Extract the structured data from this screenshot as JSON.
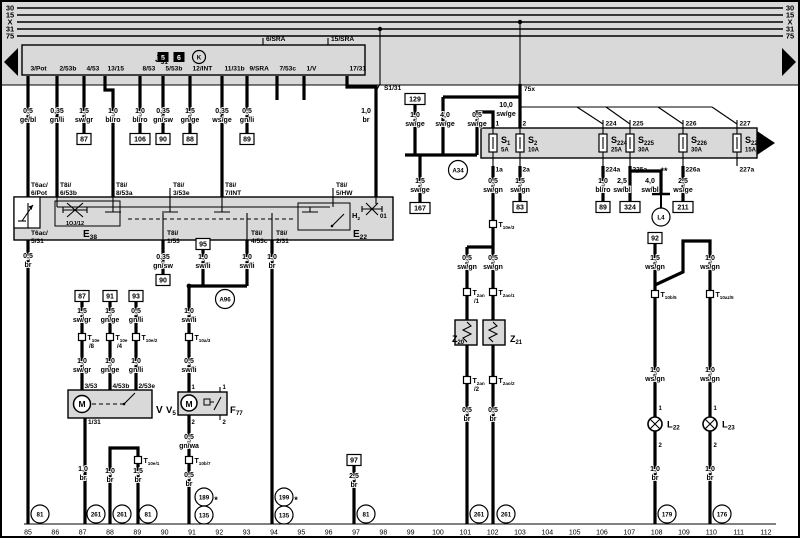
{
  "bus": {
    "left": [
      "30",
      "15",
      "X",
      "31",
      "75"
    ],
    "right": [
      "30",
      "15",
      "X",
      "31",
      "75"
    ]
  },
  "tracks": [
    "85",
    "86",
    "87",
    "88",
    "89",
    "90",
    "91",
    "92",
    "93",
    "94",
    "95",
    "96",
    "97",
    "98",
    "99",
    "100",
    "101",
    "102",
    "103",
    "104",
    "105",
    "106",
    "107",
    "108",
    "109",
    "110",
    "111",
    "112"
  ],
  "relay": {
    "name": "J|31",
    "badges": [
      {
        "x": 163,
        "y": 60,
        "t": "5"
      },
      {
        "x": 179,
        "y": 60,
        "t": "6"
      }
    ],
    "symbol": {
      "x": 199,
      "y": 57,
      "t": "K"
    }
  },
  "wspecs": [
    [
      28,
      113,
      "0,5",
      "ge/bl"
    ],
    [
      57,
      113,
      "0,35",
      "gn/li"
    ],
    [
      84,
      113,
      "1,5",
      "sw/gr"
    ],
    [
      113,
      113,
      "1,0",
      "bl/ro"
    ],
    [
      140,
      113,
      "1,0",
      "bl/ro"
    ],
    [
      163,
      113,
      "0,35",
      "gn/sw"
    ],
    [
      190,
      113,
      "1,5",
      "gn/ge"
    ],
    [
      222,
      113,
      "0,35",
      "ws/ge"
    ],
    [
      247,
      113,
      "0,5",
      "gn/li"
    ],
    [
      366,
      113,
      "1,0",
      "br"
    ],
    [
      415,
      117,
      "1,0",
      "sw/ge"
    ],
    [
      445,
      117,
      "4,0",
      "sw/ge"
    ],
    [
      477,
      117,
      "0,5",
      "sw/ge"
    ],
    [
      506,
      107,
      "10,0",
      "sw/ge"
    ],
    [
      420,
      183,
      "1,5",
      "sw/ge"
    ],
    [
      493,
      183,
      "0,5",
      "sw/gn"
    ],
    [
      520,
      183,
      "1,5",
      "sw/gn"
    ],
    [
      603,
      183,
      "1,0",
      "bl/ro"
    ],
    [
      622,
      183,
      "2,5",
      "sw/bl"
    ],
    [
      650,
      183,
      "4,0",
      "sw/bl"
    ],
    [
      683,
      183,
      "2,5",
      "ws/ge"
    ],
    [
      28,
      258,
      "0,5",
      "br"
    ],
    [
      163,
      259,
      "0,35",
      "gn/sw"
    ],
    [
      203,
      259,
      "1,0",
      "sw/li"
    ],
    [
      247,
      259,
      "1,0",
      "sw/li"
    ],
    [
      272,
      259,
      "1,0",
      "br"
    ],
    [
      189,
      313,
      "1,0",
      "sw/li"
    ],
    [
      82,
      313,
      "1,5",
      "sw/gr"
    ],
    [
      110,
      313,
      "1,5",
      "gn/ge"
    ],
    [
      136,
      313,
      "0,5",
      "gn/li"
    ],
    [
      82,
      363,
      "1,0",
      "sw/gr"
    ],
    [
      110,
      363,
      "1,0",
      "gn/ge"
    ],
    [
      136,
      363,
      "1,0",
      "gn/li"
    ],
    [
      189,
      363,
      "0,5",
      "sw/li"
    ],
    [
      189,
      439,
      "0,5",
      "gn/wa"
    ],
    [
      83,
      471,
      "1,0",
      "br"
    ],
    [
      110,
      473,
      "1,0",
      "br"
    ],
    [
      138,
      473,
      "1,5",
      "br"
    ],
    [
      189,
      477,
      "0,5",
      "br"
    ],
    [
      354,
      478,
      "2,5",
      "br"
    ],
    [
      467,
      260,
      "0,5",
      "sw/gn"
    ],
    [
      493,
      260,
      "0,5",
      "sw/gn"
    ],
    [
      467,
      412,
      "0,5",
      "br"
    ],
    [
      493,
      412,
      "0,5",
      "br"
    ],
    [
      655,
      260,
      "1,5",
      "ws/gn"
    ],
    [
      710,
      260,
      "1,0",
      "ws/gn"
    ],
    [
      655,
      372,
      "1,0",
      "ws/gn"
    ],
    [
      710,
      372,
      "1,0",
      "ws/gn"
    ],
    [
      655,
      471,
      "1,0",
      "br"
    ],
    [
      710,
      471,
      "1,0",
      "br"
    ]
  ],
  "texts": [
    [
      30.5,
      70.5,
      "3/Pot",
      "tl"
    ],
    [
      59.5,
      70.5,
      "2/53b",
      "tl"
    ],
    [
      86.5,
      70.5,
      "4/53",
      "tl"
    ],
    [
      107.5,
      70.5,
      "13/15",
      "tl"
    ],
    [
      142.5,
      70.5,
      "8/53",
      "tl"
    ],
    [
      165.5,
      70.5,
      "5/53b",
      "tl"
    ],
    [
      192.5,
      70.5,
      "12/INT",
      "tl"
    ],
    [
      224.5,
      70.5,
      "11/31b",
      "tl"
    ],
    [
      249.5,
      70.5,
      "9/SRA",
      "tl"
    ],
    [
      279.5,
      70.5,
      "7/53c",
      "tl"
    ],
    [
      306.5,
      70.5,
      "1/V",
      "tl"
    ],
    [
      349.5,
      70.5,
      "17/31",
      "tl"
    ],
    [
      266,
      41,
      "6/SRA",
      "tl"
    ],
    [
      331,
      41,
      "15/SRA",
      "tl"
    ],
    [
      384,
      90,
      "S1/31",
      "tl"
    ],
    [
      524,
      91,
      "75x",
      "tl"
    ],
    [
      31,
      187,
      "T6ac/",
      "tl"
    ],
    [
      31,
      195,
      "6/Pot",
      "tl"
    ],
    [
      60,
      187,
      "T8i/",
      "tl"
    ],
    [
      60,
      195,
      "6/53b",
      "tl"
    ],
    [
      116,
      187,
      "T8i/",
      "tl"
    ],
    [
      116,
      195,
      "8/53a",
      "tl"
    ],
    [
      173,
      187,
      "T8i/",
      "tl"
    ],
    [
      173,
      195,
      "3/53e",
      "tl"
    ],
    [
      225,
      187,
      "T8i/",
      "tl"
    ],
    [
      225,
      195,
      "7/INT",
      "tl"
    ],
    [
      336,
      187,
      "T8i/",
      "tl"
    ],
    [
      336,
      195,
      "5/HW",
      "tl"
    ],
    [
      31,
      235,
      "T6ac/",
      "tl"
    ],
    [
      31,
      243,
      "5/31",
      "tl"
    ],
    [
      167,
      235,
      "T8i/",
      "tl"
    ],
    [
      167,
      243,
      "1/53",
      "tl"
    ],
    [
      251,
      235,
      "T8i/",
      "tl"
    ],
    [
      251,
      243,
      "4/53c",
      "tl"
    ],
    [
      276,
      235,
      "T8i/",
      "tl"
    ],
    [
      276,
      243,
      "2/31",
      "tl"
    ],
    [
      84.5,
      388,
      "3/53",
      "tl"
    ],
    [
      112.5,
      388,
      "4/53b",
      "tl"
    ],
    [
      138.5,
      388,
      "2/53e",
      "tl"
    ],
    [
      88,
      424,
      "1/31",
      "tl"
    ],
    [
      191.5,
      389,
      "1",
      "pin"
    ],
    [
      191.5,
      424,
      "2",
      "pin"
    ],
    [
      222.5,
      389,
      "1",
      "pin"
    ],
    [
      222.5,
      424,
      "2",
      "pin"
    ],
    [
      380,
      218,
      "01",
      "pin"
    ],
    [
      216,
      503,
      "*",
      "star"
    ],
    [
      296,
      503,
      "*",
      "star"
    ],
    [
      637,
      176,
      "*",
      "star"
    ],
    [
      664,
      174,
      "**",
      "star"
    ],
    [
      75,
      225,
      "1OJ/12",
      "tiny"
    ],
    [
      82,
      407,
      "M",
      "mm"
    ],
    [
      189,
      407,
      "M",
      "mm"
    ]
  ],
  "comps": [
    [
      155,
      62,
      "J|31",
      10,
      "e"
    ],
    [
      83,
      237,
      "E|38",
      10
    ],
    [
      353,
      237,
      "E|22",
      10
    ],
    [
      352,
      218,
      "H|2",
      7.5
    ],
    [
      156,
      413,
      "V",
      10
    ],
    [
      166,
      413,
      "V|5",
      9.5
    ],
    [
      230,
      413,
      "F|77",
      9.5
    ],
    [
      452,
      342,
      "Z|20",
      9,
      "e"
    ],
    [
      510,
      342,
      "Z|21",
      9
    ]
  ],
  "boxes": [
    [
      84,
      139,
      "87"
    ],
    [
      140,
      139,
      "106"
    ],
    [
      163,
      139,
      "90"
    ],
    [
      190,
      139,
      "88"
    ],
    [
      247,
      139,
      "89"
    ],
    [
      415,
      99,
      "129"
    ],
    [
      420,
      208,
      "167"
    ],
    [
      520,
      207,
      "83"
    ],
    [
      603,
      207,
      "89"
    ],
    [
      630,
      207,
      "324"
    ],
    [
      683,
      207,
      "211"
    ],
    [
      655,
      238,
      "92"
    ],
    [
      203,
      244,
      "95"
    ],
    [
      163,
      280,
      "90"
    ],
    [
      82,
      296,
      "87"
    ],
    [
      110,
      296,
      "91"
    ],
    [
      136,
      296,
      "93"
    ],
    [
      354,
      460,
      "97"
    ]
  ],
  "circles": [
    [
      40,
      514,
      "81"
    ],
    [
      96,
      514,
      "261"
    ],
    [
      122,
      514,
      "261"
    ],
    [
      148,
      514,
      "81"
    ],
    [
      204,
      497,
      "189"
    ],
    [
      204,
      515,
      "135"
    ],
    [
      284,
      497,
      "199"
    ],
    [
      284,
      515,
      "135"
    ],
    [
      366,
      514,
      "81"
    ],
    [
      479,
      514,
      "261"
    ],
    [
      506,
      514,
      "261"
    ],
    [
      667,
      514,
      "179"
    ],
    [
      722,
      514,
      "176"
    ],
    [
      458,
      170,
      "A34",
      9.5
    ],
    [
      225,
      299,
      "A96",
      9.5
    ],
    [
      661,
      217,
      "L4",
      9
    ]
  ],
  "conns": [
    [
      82,
      337,
      "T|10e",
      "/8"
    ],
    [
      110,
      337,
      "T|10e",
      "/4"
    ],
    [
      136,
      337,
      "T|10e/2"
    ],
    [
      189,
      337,
      "T|10a/3"
    ],
    [
      138,
      460,
      "T|10e/1"
    ],
    [
      189,
      460,
      "T|10b/7"
    ],
    [
      493,
      224,
      "T|10e/3"
    ],
    [
      467,
      292,
      "T|2an",
      "/1"
    ],
    [
      493,
      292,
      "T|2ao/1"
    ],
    [
      467,
      380,
      "T|2an",
      "/2"
    ],
    [
      493,
      380,
      "T|2ao/2"
    ],
    [
      655,
      294,
      "T|10b/5"
    ],
    [
      710,
      294,
      "T|10az/5"
    ]
  ],
  "fuses": [
    {
      "x": 493,
      "n": "S|1",
      "a": "5A",
      "t": "1",
      "b": "1a"
    },
    {
      "x": 520,
      "n": "S|2",
      "a": "10A",
      "t": "2",
      "b": "2a"
    },
    {
      "x": 603,
      "n": "S|224",
      "a": "25A",
      "t": "224",
      "b": "224a"
    },
    {
      "x": 630,
      "n": "S|225",
      "a": "30A",
      "t": "225",
      "b": "225a"
    },
    {
      "x": 683,
      "n": "S|226",
      "a": "30A",
      "t": "226",
      "b": "226a"
    },
    {
      "x": 737,
      "n": "S|227",
      "a": "15A",
      "t": "227",
      "b": "227a"
    }
  ],
  "lamps": [
    {
      "x": 655,
      "y": 424,
      "n": "L|22",
      "p1": "1",
      "p2": "2"
    },
    {
      "x": 710,
      "y": 424,
      "n": "L|23",
      "p1": "1",
      "p2": "2"
    }
  ]
}
